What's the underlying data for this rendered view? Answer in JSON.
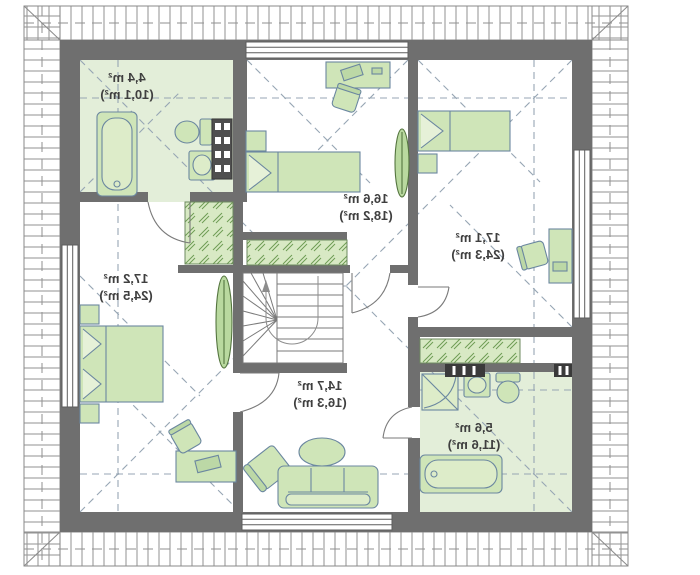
{
  "plan": {
    "kind": "attic-floor-plan",
    "rooms": [
      {
        "name": "bathroom-upper-left",
        "area": "4,4 m²",
        "floor_area": "(10,1 m²)"
      },
      {
        "name": "bedroom-middle",
        "area": "16,6 m²",
        "floor_area": "(18,2 m²)"
      },
      {
        "name": "bedroom-right",
        "area": "17,1 m²",
        "floor_area": "(24,3 m²)"
      },
      {
        "name": "bedroom-left",
        "area": "17,2 m²",
        "floor_area": "(24,5 m²)"
      },
      {
        "name": "living-hall",
        "area": "14,7 m²",
        "floor_area": "(16,3 m²)"
      },
      {
        "name": "bathroom-lower-right",
        "area": "5,6 m²",
        "floor_area": "(11,6 m²)"
      }
    ],
    "colors": {
      "wall": "#6f6f6f",
      "bathroom_floor": "#e3eed9",
      "furniture_fill": "#cfe5b8",
      "furniture_stroke": "#6b87a0",
      "closet_fill": "#d8e9c4",
      "roof_dash": "#97a6b4",
      "eaves_hatch": "#9a9a9a",
      "label_text": "#3f3f3f"
    }
  }
}
